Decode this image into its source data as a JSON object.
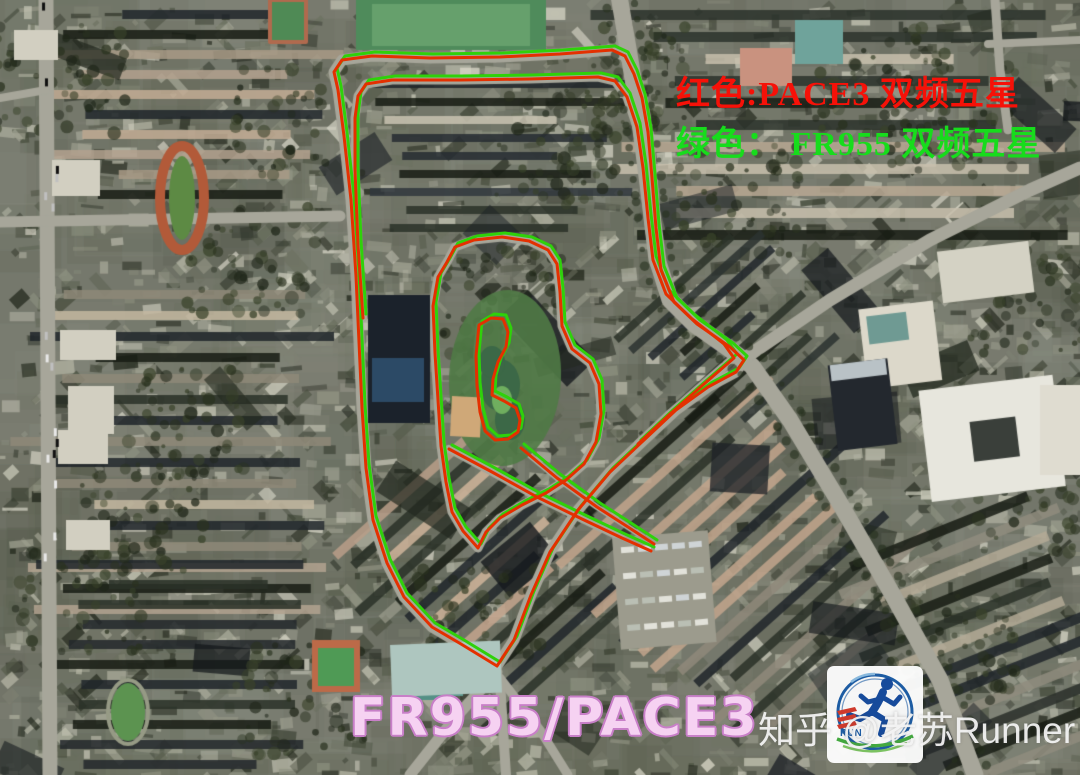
{
  "legend": {
    "red_line": "红色:PACE3  双频五星",
    "red_color": "#f61108",
    "green_line": "绿色： FR955  双频五星",
    "green_color": "#17dc1c"
  },
  "caption": {
    "text": "FR955/PACE3",
    "fill_color": "#f6d2f2",
    "outline_color": "#c87fc8"
  },
  "watermark": {
    "text": "知乎 @老苏Runner",
    "color": "rgba(245,245,245,0.93)"
  },
  "logo": {
    "run_text": "RUN",
    "ring_color": "#1d5ca3",
    "arc_color": "#8ab9dd",
    "runner_color": "#174b9b",
    "stripes_color": "#cf3a2c",
    "swoosh_color": "#43a93f",
    "swoosh2_color": "#7cc262"
  },
  "tracks": {
    "red": {
      "label": "PACE3",
      "color": "#e43000"
    },
    "green": {
      "label": "FR955",
      "color": "#2fd10a"
    },
    "stroke_width": 3,
    "green_offset": [
      3,
      -4
    ],
    "paths": [
      {
        "name": "outer-loop",
        "closed": true,
        "points": [
          [
            338,
            90
          ],
          [
            334,
            72
          ],
          [
            342,
            60
          ],
          [
            372,
            56
          ],
          [
            430,
            58
          ],
          [
            500,
            57
          ],
          [
            560,
            54
          ],
          [
            612,
            50
          ],
          [
            625,
            56
          ],
          [
            634,
            74
          ],
          [
            642,
            98
          ],
          [
            648,
            132
          ],
          [
            652,
            178
          ],
          [
            656,
            228
          ],
          [
            661,
            270
          ],
          [
            674,
            302
          ],
          [
            697,
            324
          ],
          [
            730,
            347
          ],
          [
            744,
            360
          ],
          [
            736,
            372
          ],
          [
            708,
            387
          ],
          [
            676,
            410
          ],
          [
            644,
            440
          ],
          [
            610,
            472
          ],
          [
            578,
            510
          ],
          [
            550,
            552
          ],
          [
            531,
            595
          ],
          [
            514,
            640
          ],
          [
            497,
            666
          ],
          [
            479,
            655
          ],
          [
            461,
            644
          ],
          [
            432,
            627
          ],
          [
            404,
            597
          ],
          [
            387,
            563
          ],
          [
            373,
            520
          ],
          [
            366,
            468
          ],
          [
            362,
            408
          ],
          [
            359,
            342
          ],
          [
            356,
            276
          ],
          [
            351,
            200
          ],
          [
            344,
            136
          ]
        ]
      },
      {
        "name": "inner-north-west-line",
        "closed": false,
        "points": [
          [
            363,
            318
          ],
          [
            358,
            245
          ],
          [
            355,
            170
          ],
          [
            355,
            118
          ],
          [
            358,
            96
          ],
          [
            366,
            84
          ],
          [
            392,
            80
          ],
          [
            460,
            80
          ],
          [
            530,
            79
          ],
          [
            598,
            77
          ],
          [
            615,
            81
          ],
          [
            627,
            97
          ],
          [
            637,
            127
          ],
          [
            643,
            168
          ],
          [
            648,
            218
          ],
          [
            653,
            260
          ],
          [
            666,
            294
          ],
          [
            691,
            318
          ],
          [
            724,
            344
          ],
          [
            734,
            358
          ],
          [
            704,
            384
          ],
          [
            670,
            414
          ],
          [
            638,
            444
          ]
        ]
      },
      {
        "name": "courtyard-loop",
        "closed": true,
        "points": [
          [
            447,
            262
          ],
          [
            455,
            247
          ],
          [
            474,
            240
          ],
          [
            502,
            237
          ],
          [
            529,
            241
          ],
          [
            548,
            250
          ],
          [
            557,
            264
          ],
          [
            560,
            292
          ],
          [
            562,
            326
          ],
          [
            572,
            349
          ],
          [
            590,
            363
          ],
          [
            599,
            384
          ],
          [
            601,
            414
          ],
          [
            596,
            442
          ],
          [
            584,
            464
          ],
          [
            566,
            480
          ],
          [
            546,
            493
          ],
          [
            522,
            505
          ],
          [
            500,
            518
          ],
          [
            486,
            532
          ],
          [
            478,
            548
          ],
          [
            463,
            531
          ],
          [
            452,
            512
          ],
          [
            446,
            482
          ],
          [
            441,
            446
          ],
          [
            438,
            400
          ],
          [
            435,
            353
          ],
          [
            433,
            306
          ],
          [
            438,
            277
          ]
        ]
      },
      {
        "name": "pond-loop",
        "closed": true,
        "points": [
          [
            479,
            325
          ],
          [
            491,
            318
          ],
          [
            503,
            319
          ],
          [
            508,
            332
          ],
          [
            506,
            347
          ],
          [
            498,
            362
          ],
          [
            493,
            379
          ],
          [
            492,
            395
          ],
          [
            504,
            401
          ],
          [
            516,
            408
          ],
          [
            520,
            420
          ],
          [
            518,
            432
          ],
          [
            508,
            439
          ],
          [
            495,
            440
          ],
          [
            485,
            431
          ],
          [
            480,
            412
          ],
          [
            477,
            386
          ],
          [
            476,
            356
          ]
        ]
      },
      {
        "name": "diagonal-connector-1",
        "closed": false,
        "points": [
          [
            449,
            449
          ],
          [
            492,
            472
          ],
          [
            537,
            497
          ],
          [
            582,
            519
          ],
          [
            622,
            538
          ],
          [
            651,
            551
          ]
        ]
      },
      {
        "name": "diagonal-connector-2",
        "closed": false,
        "points": [
          [
            521,
            448
          ],
          [
            557,
            478
          ],
          [
            597,
            507
          ],
          [
            628,
            527
          ],
          [
            654,
            544
          ]
        ]
      }
    ]
  }
}
